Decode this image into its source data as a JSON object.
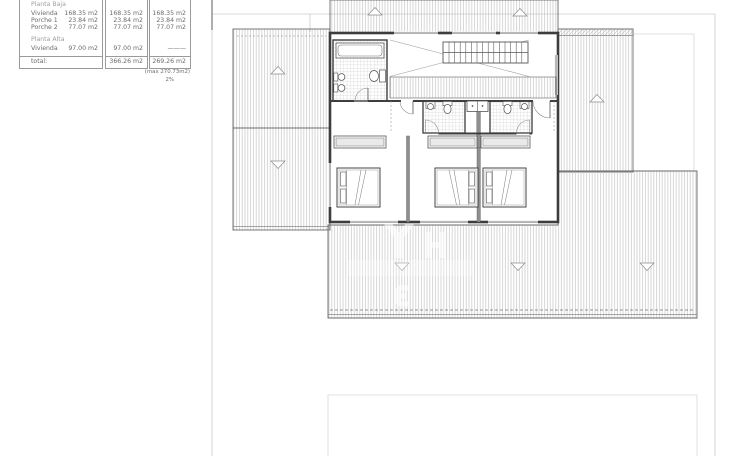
{
  "area_table": {
    "section1": {
      "title": "Planta Baja",
      "rows": [
        {
          "label": "Vivienda",
          "v1": "168.35 m2",
          "v2": "168.35 m2",
          "v3": "168.35 m2"
        },
        {
          "label": "Porche 1",
          "v1": "23.84 m2",
          "v2": "23.84 m2",
          "v3": "23.84 m2"
        },
        {
          "label": "Porche 2",
          "v1": "77.07 m2",
          "v2": "77.07 m2",
          "v3": "77.07 m2"
        }
      ]
    },
    "section2": {
      "title": "Planta Alta",
      "rows": [
        {
          "label": "Vivienda",
          "v1": "97.00 m2",
          "v2": "97.00 m2",
          "v3": "———"
        }
      ]
    },
    "total": {
      "label": "total:",
      "v2": "366.26 m2",
      "v3": "269.26 m2"
    },
    "footnote_max": "(max 270.73m2)",
    "footnote_pct": "2%"
  },
  "colors": {
    "wall": "#3d3d3d",
    "thin_line": "#666666",
    "roof_hatch": "#b6b6b6",
    "plot_boundary": "#cccccc",
    "inner_boundary": "#d8d8d8",
    "table_border": "#9a9a9a",
    "table_text": "#6b6b6b",
    "background": "#ffffff"
  }
}
